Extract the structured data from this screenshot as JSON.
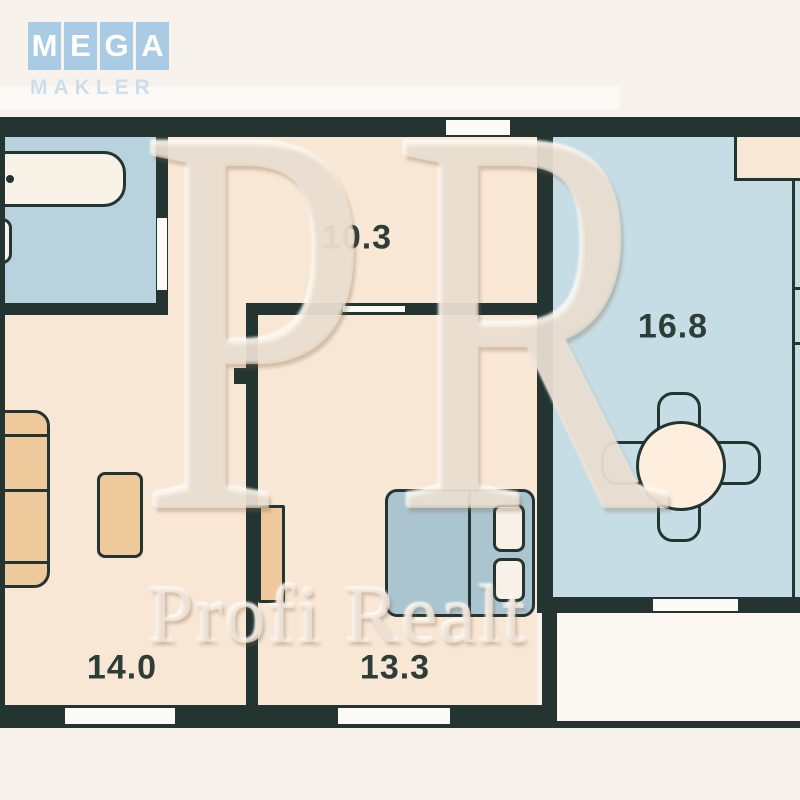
{
  "page": {
    "background": "#f7f3ec"
  },
  "logo": {
    "letters": [
      "M",
      "E",
      "G",
      "A"
    ],
    "subtitle": "MAKLER",
    "tile_color": "#a9cbe3",
    "letter_color": "#ffffff"
  },
  "watermark": {
    "monogram": "PR",
    "text": "Profi Realt"
  },
  "palette": {
    "wall": "#243531",
    "room_cream": "#f8e7d5",
    "room_blue": "#c6dde5",
    "bathroom_blue": "#b8d3de",
    "balcony_white": "#fbf8f2",
    "furniture_tan": "#edc99b",
    "bed_blue": "#abc5d0",
    "opening_white": "#fbfaf6",
    "label_color": "#2f3d39"
  },
  "rooms": [
    {
      "name": "hallway",
      "area": "10.3"
    },
    {
      "name": "room-right",
      "area": "16.8"
    },
    {
      "name": "room-left",
      "area": "14.0"
    },
    {
      "name": "bedroom",
      "area": "13.3"
    }
  ]
}
